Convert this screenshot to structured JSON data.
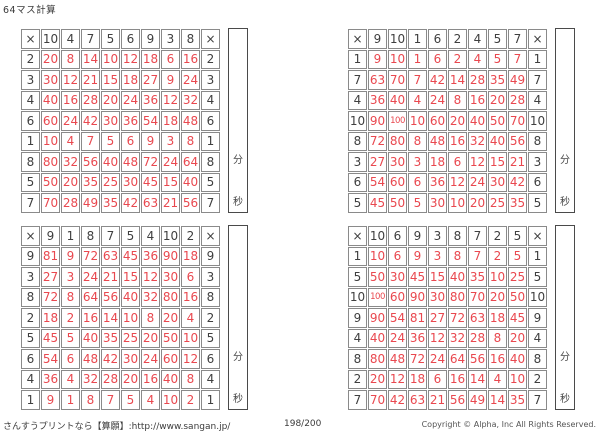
{
  "title": "64マス計算",
  "operator": "×",
  "time_labels": {
    "minutes": "分",
    "seconds": "秒"
  },
  "footer": {
    "site": "さんすうプリントなら【算願】:http://www.sangan.jp/",
    "page": "198/200",
    "copyright": "Copyright © Alpha, Inc All Rights Reserved."
  },
  "colors": {
    "answer_red": "#e9484f",
    "number_dark": "#3f3f3f",
    "grid_line": "#8a8a8a"
  },
  "grids": [
    {
      "position": "top-left",
      "cols": [
        10,
        4,
        7,
        5,
        6,
        9,
        3,
        8
      ],
      "rows": [
        2,
        3,
        4,
        6,
        1,
        8,
        5,
        7
      ],
      "values": [
        [
          20,
          8,
          14,
          10,
          12,
          18,
          6,
          16
        ],
        [
          30,
          12,
          21,
          15,
          18,
          27,
          9,
          24
        ],
        [
          40,
          16,
          28,
          20,
          24,
          36,
          12,
          32
        ],
        [
          60,
          24,
          42,
          30,
          36,
          54,
          18,
          48
        ],
        [
          10,
          4,
          7,
          5,
          6,
          9,
          3,
          8
        ],
        [
          80,
          32,
          56,
          40,
          48,
          72,
          24,
          64
        ],
        [
          50,
          20,
          35,
          25,
          30,
          45,
          15,
          40
        ],
        [
          70,
          28,
          49,
          35,
          42,
          63,
          21,
          56
        ]
      ]
    },
    {
      "position": "top-right",
      "cols": [
        9,
        10,
        1,
        6,
        2,
        4,
        5,
        7
      ],
      "rows": [
        1,
        7,
        4,
        10,
        8,
        3,
        6,
        5
      ],
      "values": [
        [
          9,
          10,
          1,
          6,
          2,
          4,
          5,
          7
        ],
        [
          63,
          70,
          7,
          42,
          14,
          28,
          35,
          49
        ],
        [
          36,
          40,
          4,
          24,
          8,
          16,
          20,
          28
        ],
        [
          90,
          100,
          10,
          60,
          20,
          40,
          50,
          70
        ],
        [
          72,
          80,
          8,
          48,
          16,
          32,
          40,
          56
        ],
        [
          27,
          30,
          3,
          18,
          6,
          12,
          15,
          21
        ],
        [
          54,
          60,
          6,
          36,
          12,
          24,
          30,
          42
        ],
        [
          45,
          50,
          5,
          30,
          10,
          20,
          25,
          35
        ]
      ]
    },
    {
      "position": "bottom-left",
      "cols": [
        9,
        1,
        8,
        7,
        5,
        4,
        10,
        2
      ],
      "rows": [
        9,
        3,
        8,
        2,
        5,
        6,
        4,
        1
      ],
      "values": [
        [
          81,
          9,
          72,
          63,
          45,
          36,
          90,
          18
        ],
        [
          27,
          3,
          24,
          21,
          15,
          12,
          30,
          6
        ],
        [
          72,
          8,
          64,
          56,
          40,
          32,
          80,
          16
        ],
        [
          18,
          2,
          16,
          14,
          10,
          8,
          20,
          4
        ],
        [
          45,
          5,
          40,
          35,
          25,
          20,
          50,
          10
        ],
        [
          54,
          6,
          48,
          42,
          30,
          24,
          60,
          12
        ],
        [
          36,
          4,
          32,
          28,
          20,
          16,
          40,
          8
        ],
        [
          9,
          1,
          8,
          7,
          5,
          4,
          10,
          2
        ]
      ]
    },
    {
      "position": "bottom-right",
      "cols": [
        10,
        6,
        9,
        3,
        8,
        7,
        2,
        5
      ],
      "rows": [
        1,
        5,
        10,
        9,
        4,
        8,
        2,
        7
      ],
      "values": [
        [
          10,
          6,
          9,
          3,
          8,
          7,
          2,
          5
        ],
        [
          50,
          30,
          45,
          15,
          40,
          35,
          10,
          25
        ],
        [
          100,
          60,
          90,
          30,
          80,
          70,
          20,
          50
        ],
        [
          90,
          54,
          81,
          27,
          72,
          63,
          18,
          45
        ],
        [
          40,
          24,
          36,
          12,
          32,
          28,
          8,
          20
        ],
        [
          80,
          48,
          72,
          24,
          64,
          56,
          16,
          40
        ],
        [
          20,
          12,
          18,
          6,
          16,
          14,
          4,
          10
        ],
        [
          70,
          42,
          63,
          21,
          56,
          49,
          14,
          35
        ]
      ]
    }
  ]
}
